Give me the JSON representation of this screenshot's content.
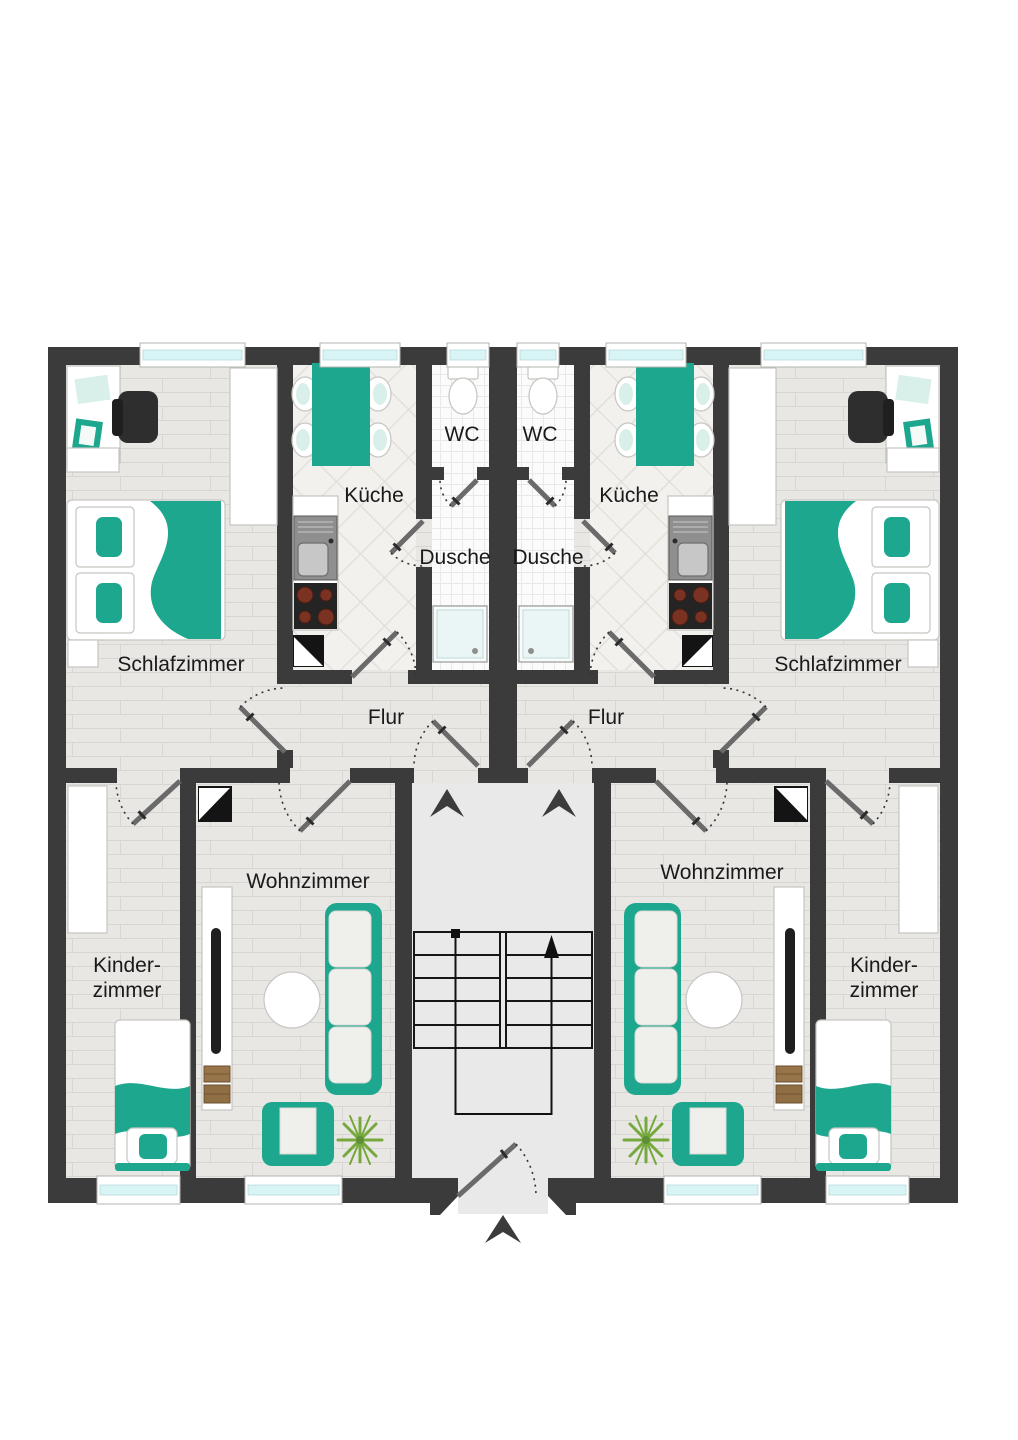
{
  "plan": {
    "type": "apartment-floor-plan",
    "language": "de",
    "rooms": {
      "schlafzimmer_left": "Schlafzimmer",
      "kueche_left": "Küche",
      "wc_left": "WC",
      "dusche_left": "Dusche",
      "flur_left": "Flur",
      "wohnzimmer_left": "Wohnzimmer",
      "kinderzimmer_left_1": "Kinder-",
      "kinderzimmer_left_2": "zimmer",
      "schlafzimmer_right": "Schlafzimmer",
      "kueche_right": "Küche",
      "wc_right": "WC",
      "dusche_right": "Dusche",
      "flur_right": "Flur",
      "wohnzimmer_right": "Wohnzimmer",
      "kinderzimmer_right_1": "Kinder-",
      "kinderzimmer_right_2": "zimmer"
    },
    "colors": {
      "wall": "#3b3b3b",
      "accent_teal": "#1ca78e",
      "accent_teal_light": "#d9efe9",
      "window_glass": "#d8f4f5",
      "floor_wood": "#e8e7e4",
      "floor_wood_line": "#d8d6d2",
      "floor_tile_kitchen": "#f2f1ed",
      "floor_tile_kitchen_line": "#dfddd8",
      "floor_tile_bath": "#fbfbfb",
      "floor_tile_bath_line": "#e8e8e8",
      "floor_stairwell": "#e9e9e9",
      "door_leaf": "#6a6a6a",
      "door_arc": "#333333",
      "furniture_border": "#c6c5c1",
      "dark_furniture": "#2e2e2e",
      "stove_top": "#242424",
      "burner": "#7a3322",
      "plant_green": "#76a83e",
      "books_brown": "#97744a",
      "label_text": "#1a1a1a",
      "background": "#ffffff"
    }
  }
}
